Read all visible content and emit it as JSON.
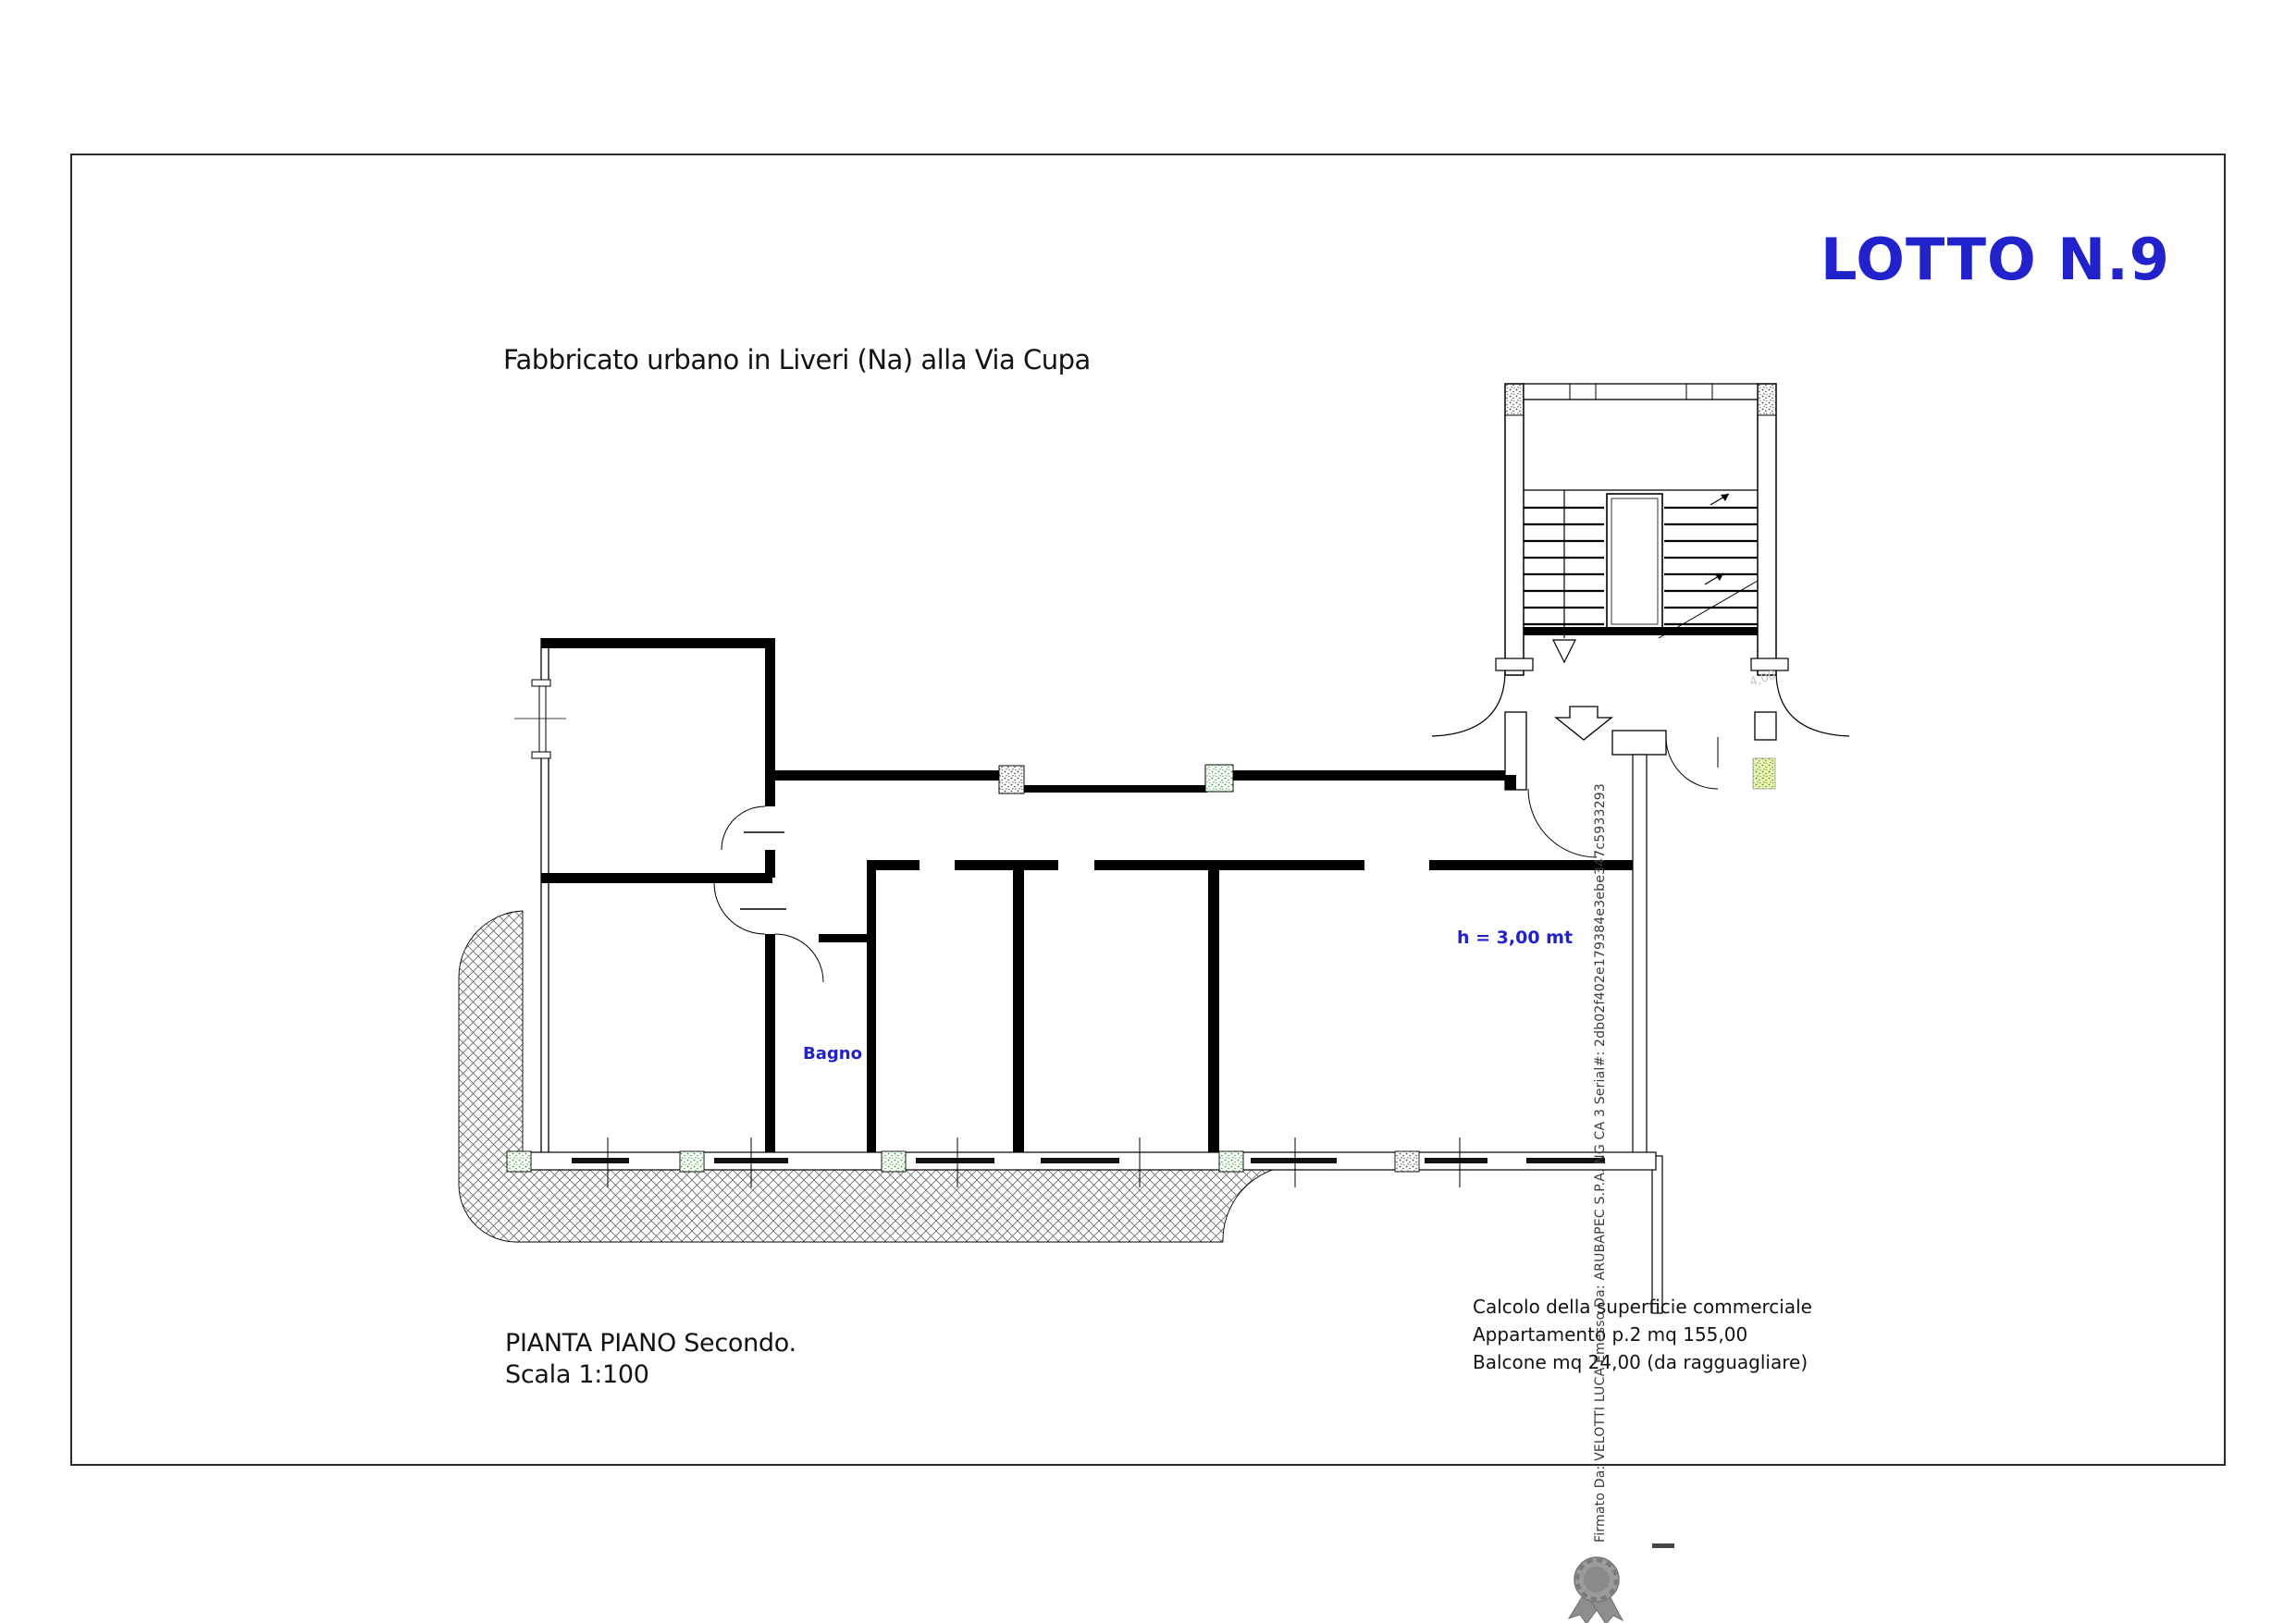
{
  "header": {
    "lot_title": "LOTTO N.9"
  },
  "drawing": {
    "subtitle": "Fabbricato urbano in Liveri (Na) alla Via Cupa",
    "room_label": "Bagno",
    "height_label": "h = 3,00 mt",
    "dim_label": "4,00",
    "caption": {
      "line1": "PIANTA PIANO Secondo.",
      "line2": "Scala 1:100"
    }
  },
  "area_calc": {
    "line1": "Calcolo della superficie commerciale",
    "line2": "Appartamento p.2 mq 155,00",
    "line3": "Balcone mq 24,00 (da ragguagliare)"
  },
  "signature": {
    "text": "Firmato Da: VELOTTI LUCA Emesso Da: ARUBAPEC S.P.A. NG CA 3 Serial#: 2db02f402e179384e3ebe347c5933293"
  },
  "colors": {
    "accent_blue": "#2222cc",
    "drawing_black": "#000000",
    "pillar_green": "#2f9e2f",
    "pillar_yellow_bg": "#f2f2b0",
    "signature_gray": "#3a3a3a",
    "ribbon_gray": "#8e8e8e"
  }
}
